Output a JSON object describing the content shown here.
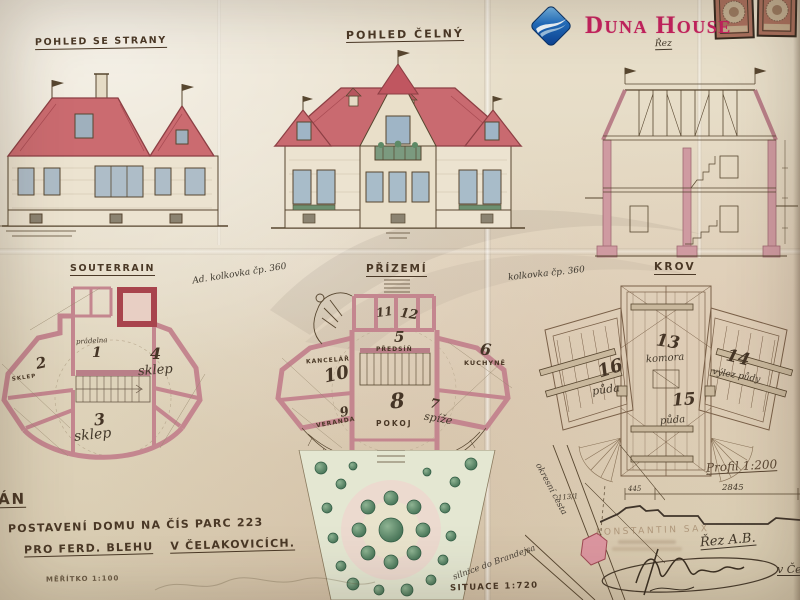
{
  "photo": {
    "description": "aged architectural blueprint photograph",
    "paper_color": "#e2d8c3",
    "ink_color": "#57462f",
    "roof_color": "#c96a70",
    "plan_wall_color": "#c4868f",
    "tree_color": "#4e7d5e"
  },
  "logo": {
    "brand": "Duna House",
    "text_color": "#c6215f",
    "diamond_color": "#1457a8",
    "icon": "diamond-wave"
  },
  "views": {
    "side": {
      "label": "POHLED SE STRANY"
    },
    "front": {
      "label": "POHLED ČELNÝ"
    },
    "section": {
      "label": "Řez"
    },
    "basement": {
      "label": "SOUTERRAIN",
      "rooms": [
        {
          "num": "1",
          "name": "prádelna"
        },
        {
          "num": "2",
          "name": "SKLEP"
        },
        {
          "num": "3",
          "name": "sklep"
        },
        {
          "num": "4",
          "name": "sklep"
        }
      ]
    },
    "ground": {
      "label": "PŘÍZEMÍ",
      "rooms": [
        {
          "num": "5",
          "name": "PŘEDSÍŇ"
        },
        {
          "num": "6",
          "name": "KUCHYNĚ"
        },
        {
          "num": "7",
          "name": "spíže"
        },
        {
          "num": "8",
          "name": "POKOJ"
        },
        {
          "num": "9",
          "name": "VERANDA"
        },
        {
          "num": "10",
          "name": "KANCELÁŘ"
        },
        {
          "num": "11"
        },
        {
          "num": "12"
        }
      ]
    },
    "roof": {
      "label": "KROV",
      "rooms": [
        {
          "num": "13",
          "name": "komora"
        },
        {
          "num": "14",
          "name": "výlez půdy"
        },
        {
          "num": "15",
          "name": "půda"
        },
        {
          "num": "16",
          "name": "půda"
        }
      ]
    }
  },
  "title_block": {
    "plan_word_partial": "ÁN",
    "line1": "POSTAVENÍ DOMU NA ČÍS PARC 223",
    "line2a": "PRO FERD. BLEHU",
    "line2b": "V ČELAKOVICÍCH.",
    "scale": "MĚŘÍTKO 1:100"
  },
  "notes": {
    "stamp_note_left": "Ad. kolkovka čp. 360",
    "stamp_note_right": "kolkovka čp. 360",
    "situace": "SITUACE 1:720",
    "profil": "Profil 1:200",
    "rez_ab": "Řez A.B.",
    "architect_stamp": "KONSTANTIN SAX",
    "dim_total": "2845",
    "dim_left": "445",
    "parcel_number": "113/1",
    "road_label": "okresní cesta",
    "road_label2": "silnice do Brandejsa",
    "place_cut": "v Če"
  }
}
